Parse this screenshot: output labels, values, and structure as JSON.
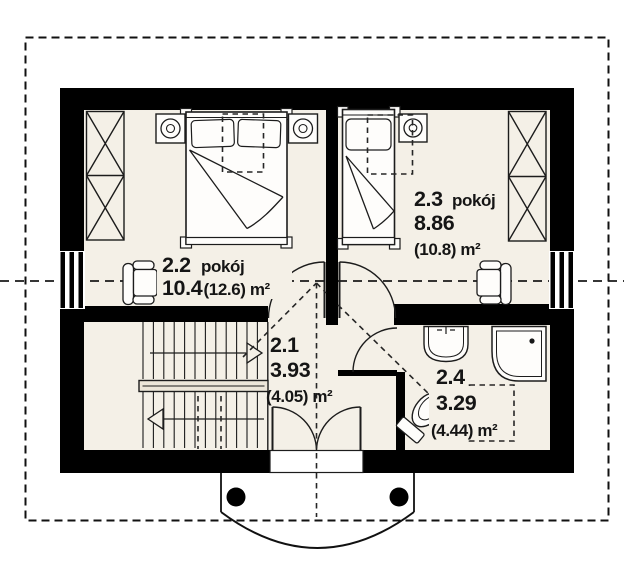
{
  "plan": {
    "rooms": [
      {
        "number": "2.1",
        "label": "",
        "area": "3.93",
        "area_note": "(4.05) m²"
      },
      {
        "number": "2.2",
        "label": "pokój",
        "area": "10.4",
        "area_note": "(12.6) m²"
      },
      {
        "number": "2.3",
        "label": "pokój",
        "area": "8.86",
        "area_note": "(10.8) m²"
      },
      {
        "number": "2.4",
        "label": "",
        "area": "3.29",
        "area_note": "(4.44) m²"
      }
    ],
    "colors": {
      "wall": "#000000",
      "floor": "#f4f0e7",
      "paper": "#ffffff",
      "ink": "#151515"
    },
    "furniture_icons": [
      "wardrobe-icon",
      "double-bed-icon",
      "single-bed-icon",
      "nightstand-lamp-icon",
      "armchair-icon",
      "staircase-icon",
      "washbasin-icon",
      "corner-bathtub-icon",
      "toilet-icon",
      "balcony-post-icon"
    ]
  }
}
